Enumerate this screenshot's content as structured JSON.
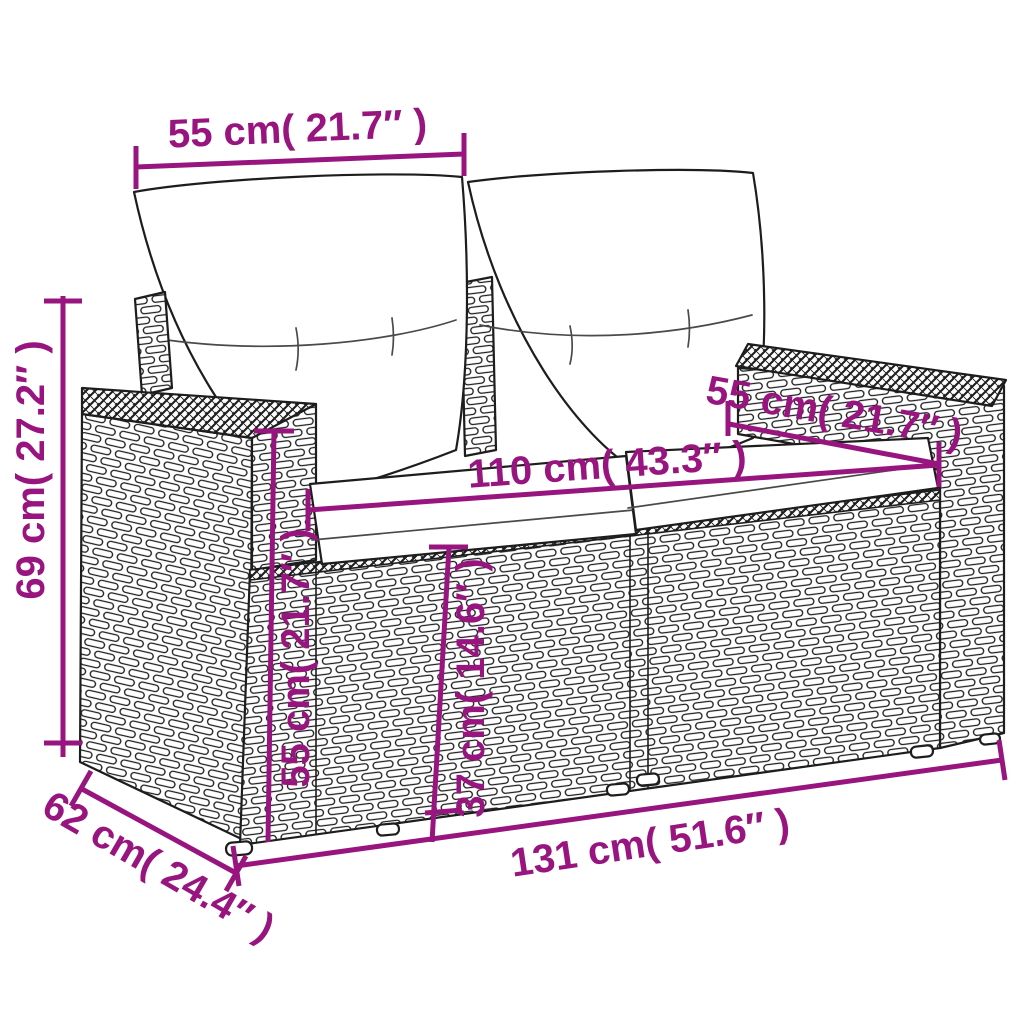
{
  "figure": {
    "alt": "Line drawing of a two-seater poly rattan garden sofa with two back cushions and two seat cushions, shown in perspective with dimension lines"
  },
  "colors": {
    "accent": "#98157F",
    "line": "#1d1d1d",
    "background": "#ffffff"
  },
  "dimensions": [
    {
      "id": "backrest-cushion-width",
      "label": "55 cm( 21.7″ )"
    },
    {
      "id": "overall-height",
      "label": "69 cm( 27.2″ )"
    },
    {
      "id": "armrest-top-depth",
      "label": "55 cm( 21.7″ )"
    },
    {
      "id": "seat-width",
      "label": "110 cm( 43.3″ )"
    },
    {
      "id": "armrest-height",
      "label": "55 cm( 21.7″ )"
    },
    {
      "id": "seat-height",
      "label": "37 cm( 14.6″ )"
    },
    {
      "id": "overall-width",
      "label": "131 cm( 51.6″ )"
    },
    {
      "id": "overall-depth",
      "label": "62 cm( 24.4″ )"
    }
  ]
}
